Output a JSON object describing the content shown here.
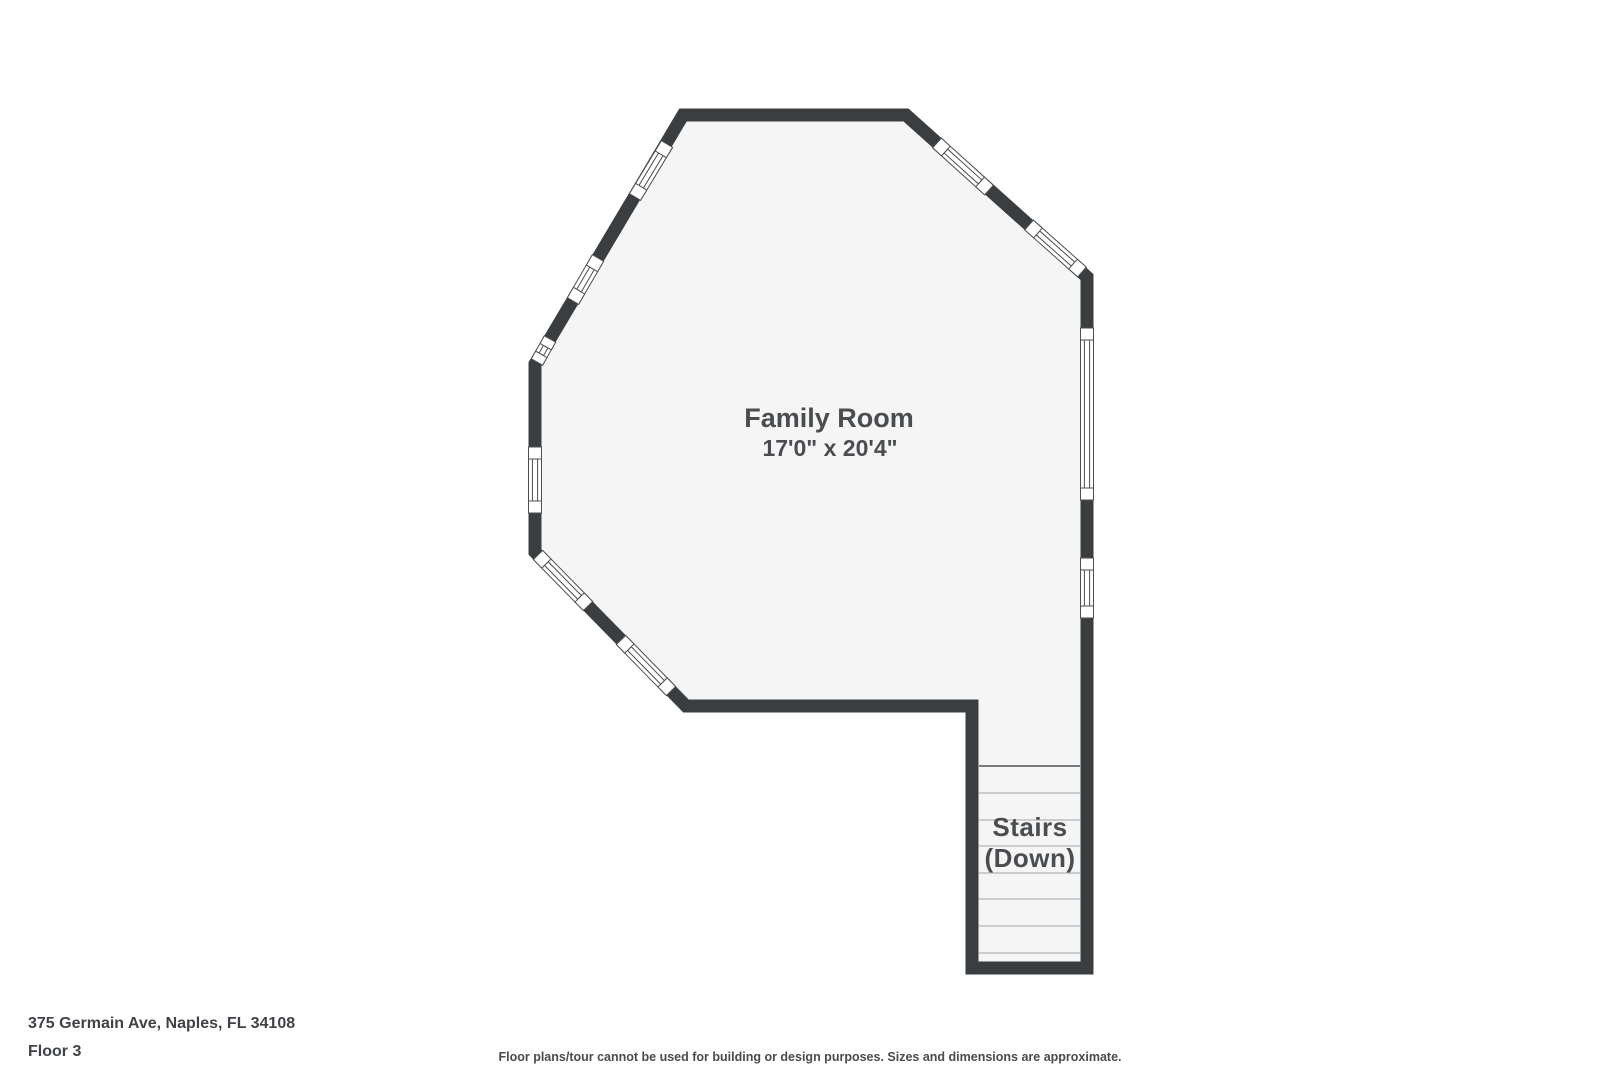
{
  "labels": {
    "room_name": "Family Room",
    "room_dimensions": "17'0\" x 20'4\"",
    "stairs_line1": "Stairs",
    "stairs_line2": "(Down)"
  },
  "footer": {
    "address": "375 Germain Ave, Naples, FL 34108",
    "floor_label": "Floor 3",
    "disclaimer": "Floor plans/tour cannot be used for building or design purposes. Sizes and dimensions are approximate."
  },
  "colors": {
    "wall": "#3b3e41",
    "room_fill": "#f5f5f6",
    "window_outline": "#4c4f52",
    "window_fill": "#ffffff",
    "stair_tread": "#b4b4b6",
    "stair_boundary": "#77797c",
    "label_text": "#4a4d50",
    "footer_text": "#3f4347",
    "disclaimer_text": "#4b4b4b",
    "page_background": "#ffffff"
  },
  "floorplan": {
    "wall_thickness": 13,
    "outline": [
      [
        683,
        115
      ],
      [
        906,
        115
      ],
      [
        1087,
        277
      ],
      [
        1087,
        968
      ],
      [
        972,
        968
      ],
      [
        972,
        706
      ],
      [
        686,
        706
      ],
      [
        535,
        552
      ],
      [
        535,
        364
      ]
    ],
    "windows": [
      {
        "x1": 535,
        "y1": 447,
        "x2": 535,
        "y2": 513
      },
      {
        "x1": 1087,
        "y1": 328,
        "x2": 1087,
        "y2": 500
      },
      {
        "x1": 1087,
        "y1": 558,
        "x2": 1087,
        "y2": 618
      },
      {
        "x1": 667,
        "y1": 144,
        "x2": 635,
        "y2": 197
      },
      {
        "x1": 598,
        "y1": 258,
        "x2": 573,
        "y2": 301
      },
      {
        "x1": 550,
        "y1": 339,
        "x2": 537,
        "y2": 362
      },
      {
        "x1": 937,
        "y1": 143,
        "x2": 989,
        "y2": 190
      },
      {
        "x1": 1029,
        "y1": 225,
        "x2": 1082,
        "y2": 272
      },
      {
        "x1": 538,
        "y1": 555,
        "x2": 588,
        "y2": 606
      },
      {
        "x1": 621,
        "y1": 640,
        "x2": 671,
        "y2": 691
      }
    ],
    "stairs": {
      "x1": 979,
      "x2": 1080,
      "boundary_y": 766,
      "tread_ys": [
        793,
        820,
        846,
        873,
        899,
        926,
        953
      ]
    }
  }
}
